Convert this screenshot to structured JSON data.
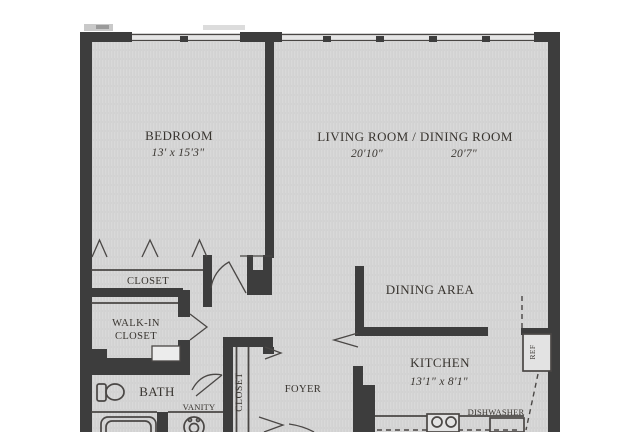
{
  "colors": {
    "wall": "#3d3d3d",
    "line": "#4a4745",
    "text": "#38342f",
    "floor": "#d9d9d9",
    "floor_stripe": "#cdcdcd",
    "window_band": "#e6e6e6",
    "appliance": "#e3e3e3",
    "background": "#ffffff"
  },
  "rooms": {
    "bedroom": {
      "name": "BEDROOM",
      "dimensions": "13' x 15'3\""
    },
    "living_dining": {
      "name": "LIVING ROOM / DINING ROOM",
      "dimension_left": "20'10\"",
      "dimension_right": "20'7\""
    },
    "bedroom_closet": {
      "name": "CLOSET"
    },
    "walk_in_closet": {
      "name_line1": "WALK-IN",
      "name_line2": "CLOSET"
    },
    "bath": {
      "name": "BATH"
    },
    "vanity": {
      "name": "VANITY"
    },
    "foyer_closet": {
      "name": "CLOSET"
    },
    "foyer": {
      "name": "FOYER"
    },
    "dining_area": {
      "name": "DINING AREA"
    },
    "kitchen": {
      "name": "KITCHEN",
      "dimensions": "13'1\" x 8'1\""
    },
    "dishwasher": {
      "name": "DISHWASHER"
    },
    "refrigerator": {
      "name": "REF"
    }
  }
}
